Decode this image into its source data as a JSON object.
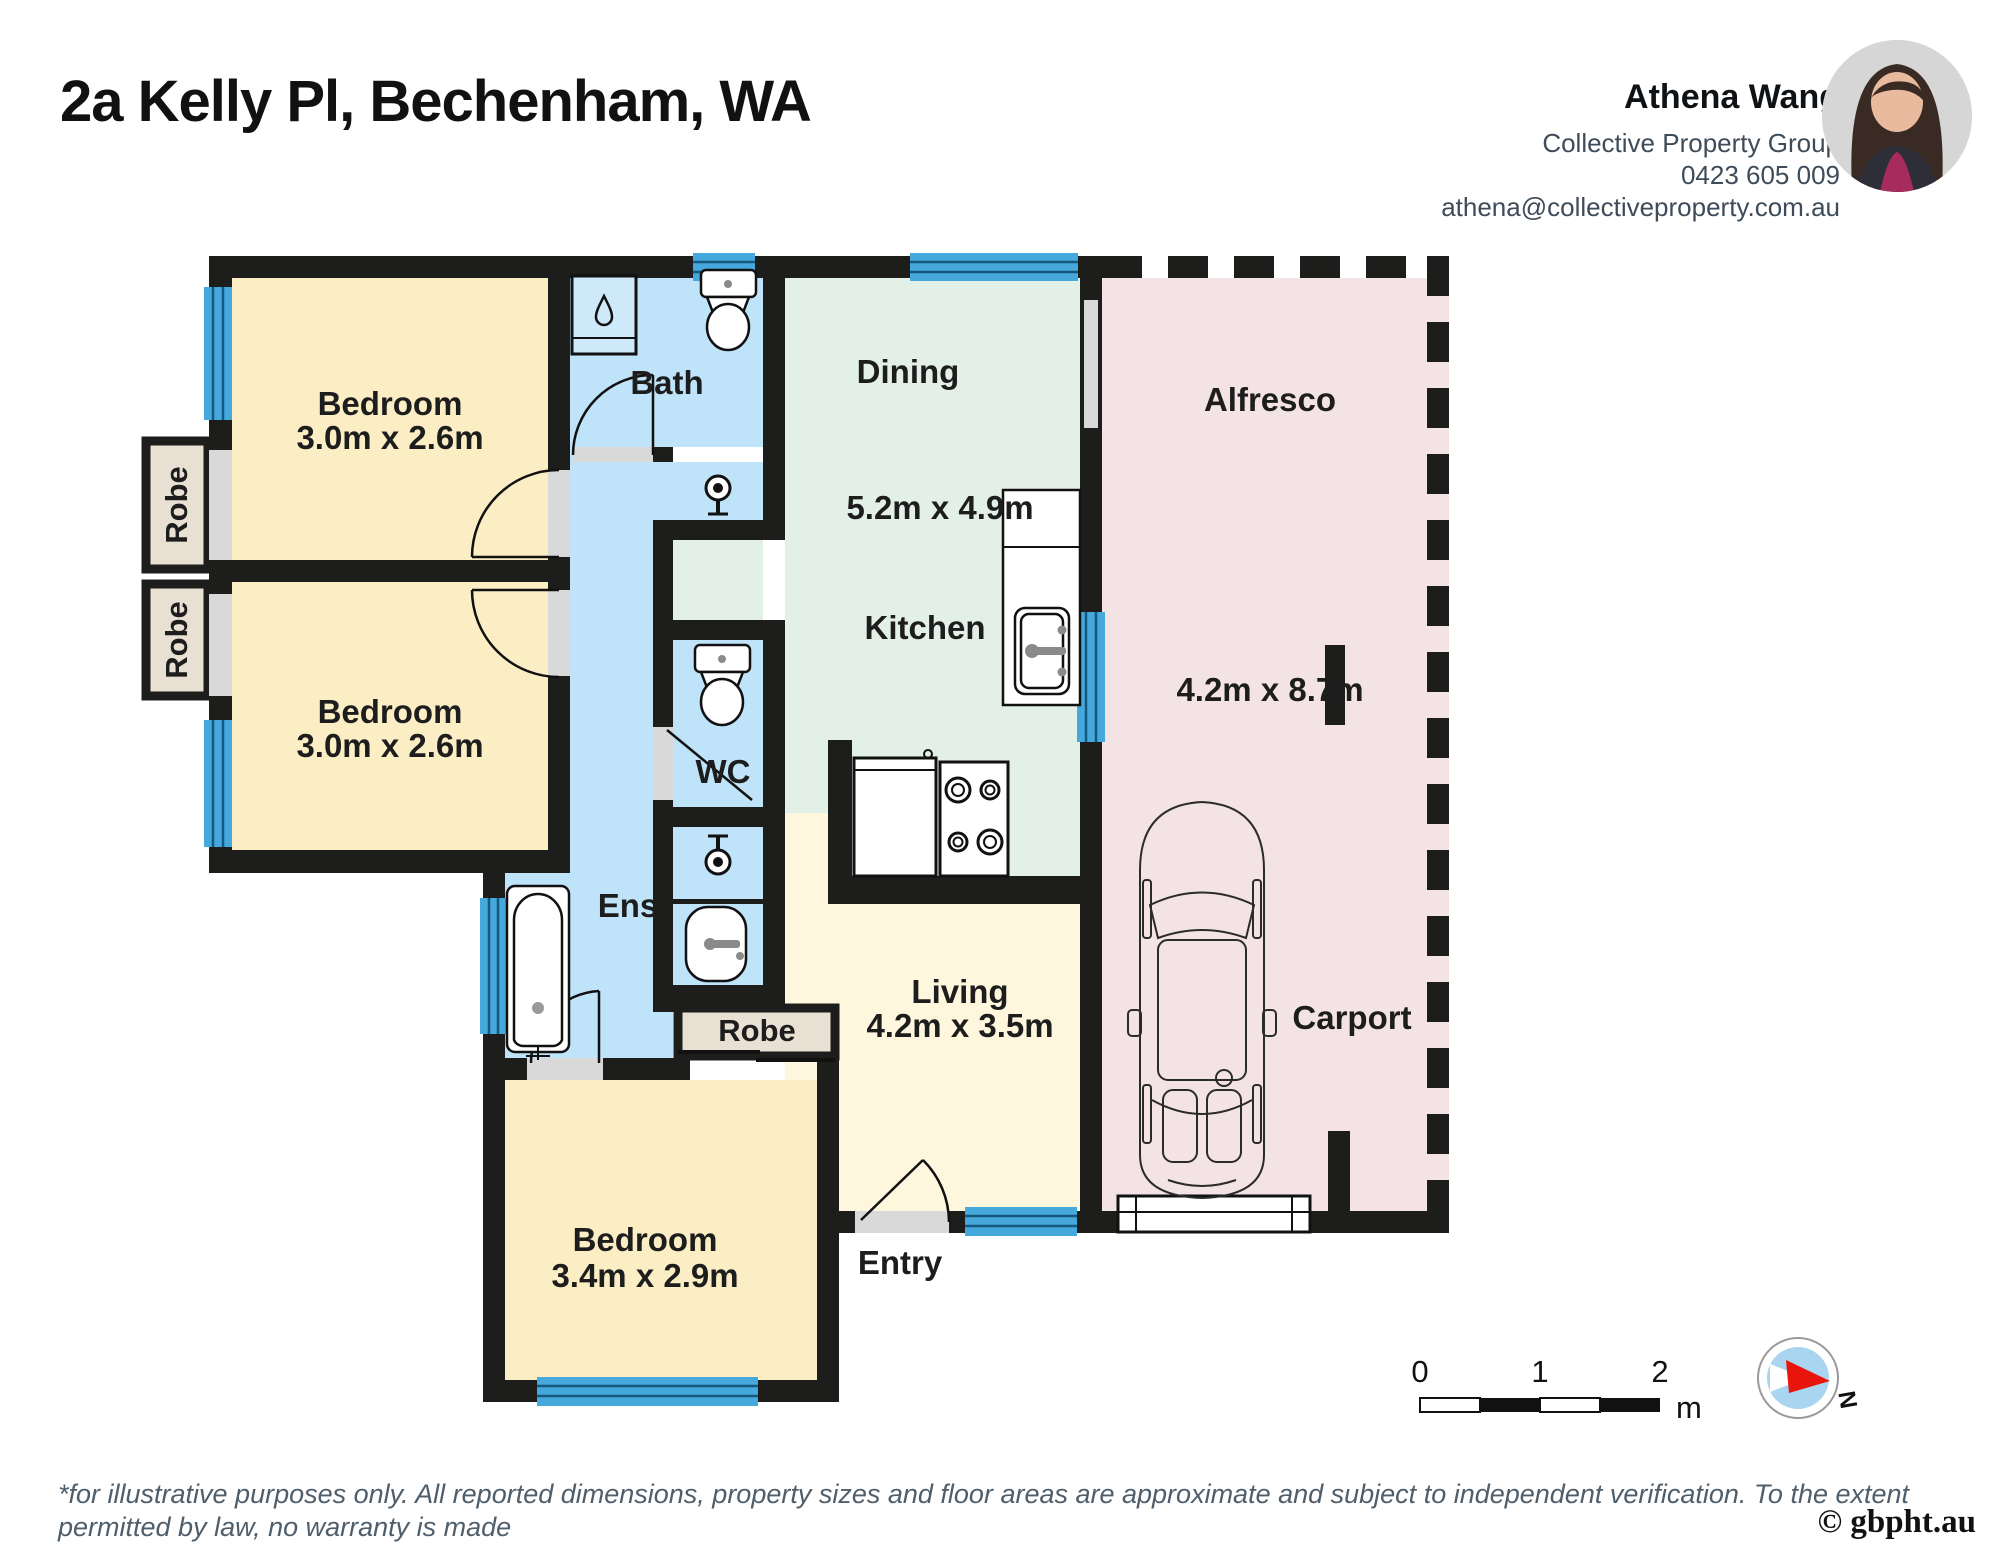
{
  "header": {
    "title": "2a Kelly Pl, Bechenham, WA"
  },
  "agent": {
    "name": "Athena Wang",
    "company": "Collective Property Group",
    "phone": "0423 605 009",
    "email": "athena@collectiveproperty.com.au"
  },
  "rooms": {
    "bedroom1": {
      "label": "Bedroom",
      "dims": "3.0m x 2.6m"
    },
    "bedroom2": {
      "label": "Bedroom",
      "dims": "3.0m x 2.6m"
    },
    "bedroom3": {
      "label": "Bedroom",
      "dims": "3.4m x 2.9m"
    },
    "bath": {
      "label": "Bath"
    },
    "wc": {
      "label": "WC"
    },
    "ens": {
      "label": "Ens"
    },
    "dining": {
      "label": "Dining",
      "dims": "5.2m x 4.9m"
    },
    "kitchen": {
      "label": "Kitchen"
    },
    "living": {
      "label": "Living",
      "dims": "4.2m x 3.5m"
    },
    "alfresco": {
      "label": "Alfresco",
      "dims": "4.2m x 8.7m"
    },
    "carport": {
      "label": "Carport"
    },
    "entry": {
      "label": "Entry"
    },
    "robe1": {
      "label": "Robe"
    },
    "robe2": {
      "label": "Robe"
    },
    "robe3": {
      "label": "Robe"
    }
  },
  "scale_bar": {
    "tick0": "0",
    "tick1": "1",
    "tick2": "2",
    "unit": "m"
  },
  "compass": {
    "north_label": "N"
  },
  "footer": {
    "disclaimer_line1": "*for illustrative purposes only. All reported dimensions, property sizes and floor areas are approximate and subject to independent verification. To the extent permitted by law, no warranty is made",
    "disclaimer_line2": "as to accuracy or completeness, and no liability will be accepted for any errors or omissions.",
    "copyright": "© gbpht.au"
  },
  "colors": {
    "wall": "#1D1D1B",
    "bedroom_fill": "#FBEEC5",
    "living_fill": "#FEF7DE",
    "wet_area_fill": "#BFE3F9",
    "dining_fill": "#E3F0E8",
    "outdoor_fill": "#F4E3E5",
    "robe_fill": "#E8E0D2",
    "window_blue": "#45A9DE",
    "door_gray": "#D9D9D9"
  }
}
